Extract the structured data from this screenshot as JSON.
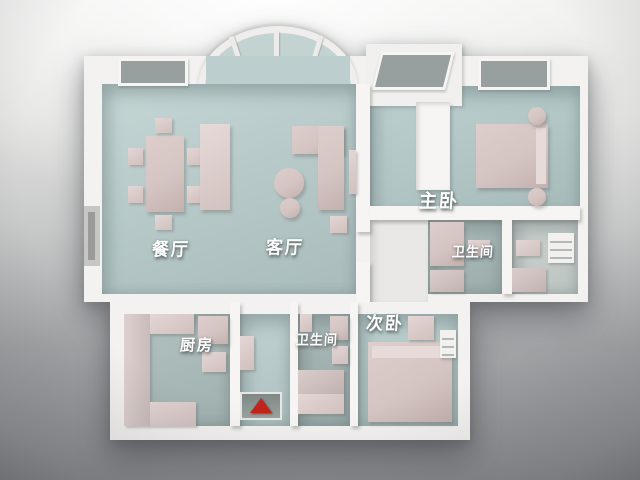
{
  "scene": {
    "kind": "3D rendered apartment floor plan model",
    "view": "top-down perspective render on gray studio backdrop"
  },
  "palette": {
    "wall": "#f3f2f0",
    "wall_shadow": "#d6d5d2",
    "floor_living": "#b7cac9",
    "floor_master": "#b2c6c6",
    "floor_wet": "#a0b1b0",
    "floor_closet": "#c5ccc9",
    "furniture_pink": "#d6c6c4",
    "entry_marker_red": "#c0251b",
    "label_color": "#ffffff",
    "background_top": "#f1f1f0",
    "background_bottom": "#8c8d90"
  },
  "rooms": [
    {
      "id": "dining-room",
      "label": "餐厅"
    },
    {
      "id": "living-room",
      "label": "客厅"
    },
    {
      "id": "master-bedroom",
      "label": "主卧"
    },
    {
      "id": "ensuite-bathroom",
      "label": "卫生间"
    },
    {
      "id": "bathroom",
      "label": "卫生间"
    },
    {
      "id": "kitchen",
      "label": "厨房"
    },
    {
      "id": "second-bedroom",
      "label": "次卧"
    }
  ],
  "marker": {
    "name": "entrance-marker-cone",
    "shape": "cone",
    "color": "#c0251b"
  }
}
